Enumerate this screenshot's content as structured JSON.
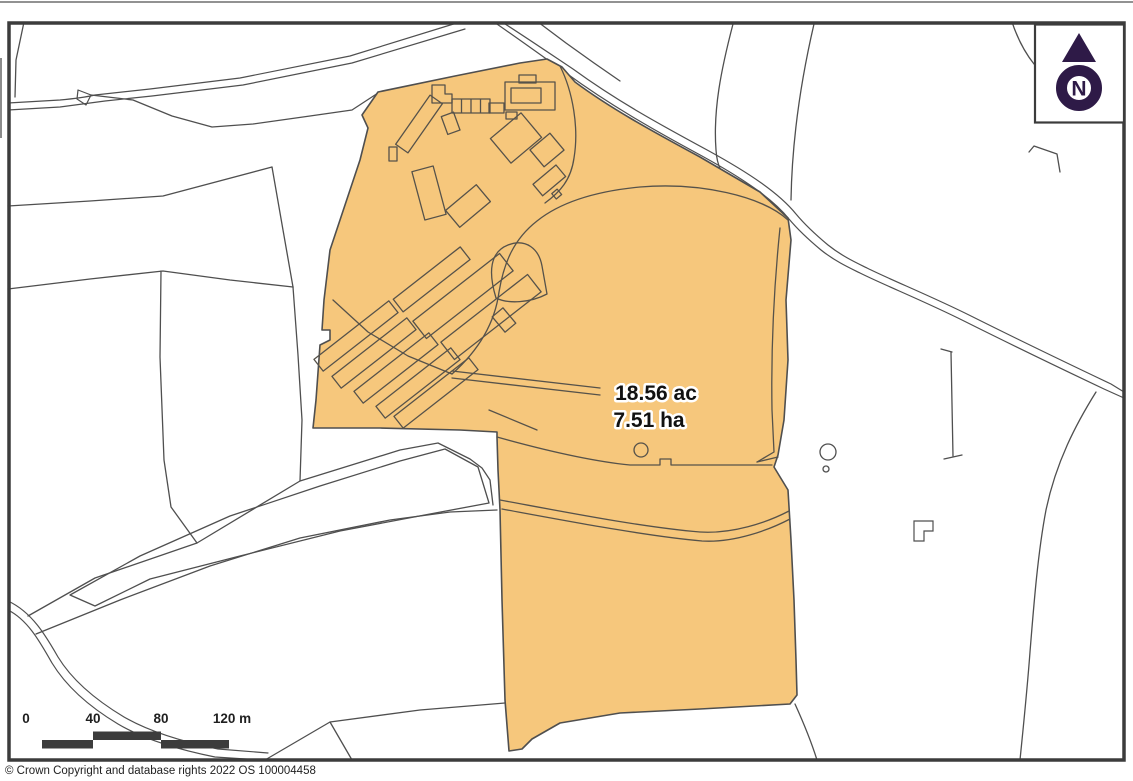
{
  "map": {
    "parcel": {
      "area_acres_label": "18.56 ac",
      "area_hectares_label": "7.51 ha"
    },
    "north_indicator": {
      "letter": "N"
    },
    "scale_bar": {
      "tick_labels": [
        "0",
        "40",
        "80",
        "120 m"
      ]
    },
    "attribution": "© Crown Copyright and database rights 2022 OS 100004458",
    "colors": {
      "background": "#FFFFFF",
      "parcel_fill": "#F6C77C",
      "boundary_line": "#4F4F4F",
      "parcel_line": "#56524A",
      "frame": "#3C3C3C",
      "scale_bar": "#3C3C3C",
      "north_arrow": "#2E1A47",
      "label_text": "#111111",
      "label_halo": "#FFFFFF"
    }
  }
}
